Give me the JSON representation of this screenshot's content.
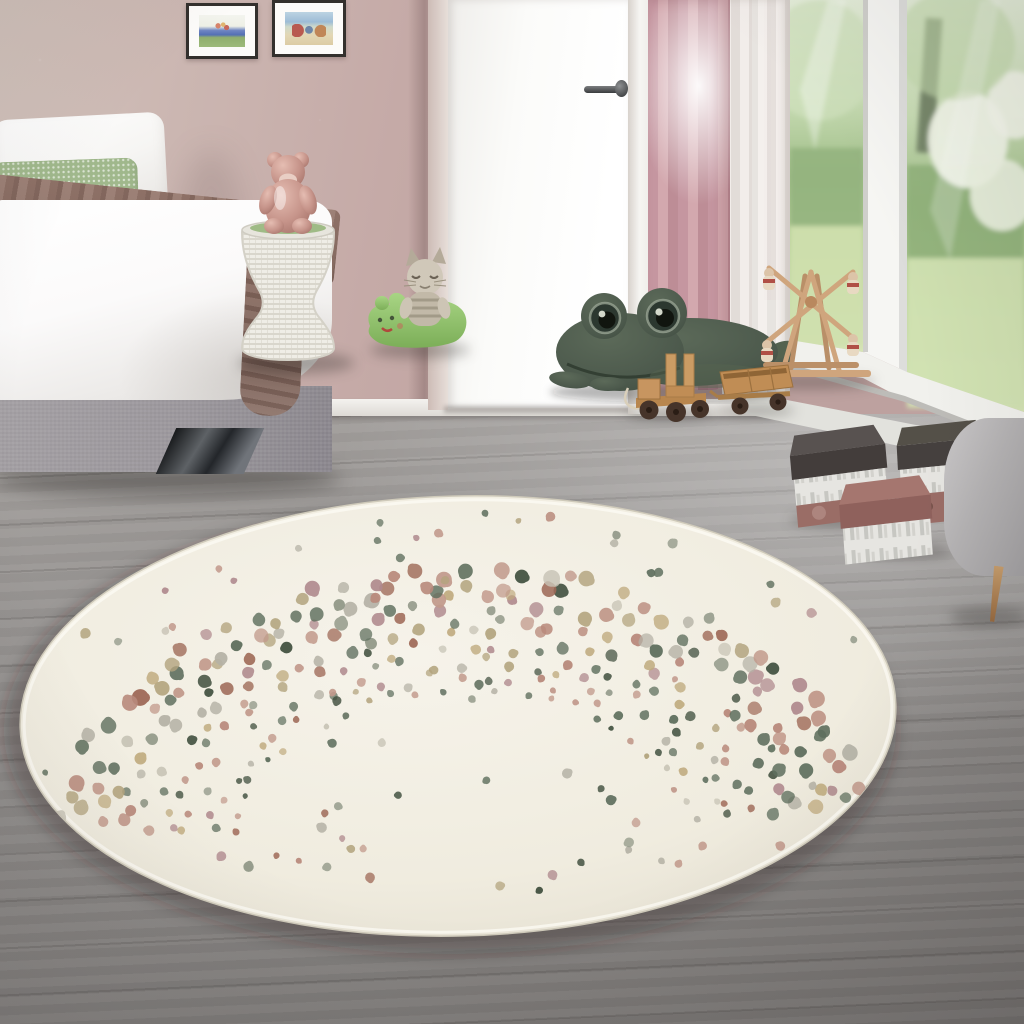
{
  "scene": {
    "type": "product-lifestyle-photo",
    "description": "Children's bedroom with dusty-pink walls, a bed with white bedding and a brown throw, a white woven stool with a rose gummy-bear figurine, plush toys (cat, green pillow animal, large green frog), wooden toys (ferris wheel, pull-along truck and cart), an open white door with pink and sheer curtains, a large garden window, decorative storage boxes, a grey armchair corner, grey wood floor, and a large round cream kids rug decorated with a rainbow arc of multicoloured speckled dots",
    "objects": [
      "wall",
      "framed-picture-left",
      "framed-picture-right",
      "bed",
      "white-pillow",
      "green-knit-pillow",
      "white-duvet",
      "brown-blanket",
      "bed-base",
      "chrome-bed-foot",
      "woven-stool",
      "gummy-bear-figurine",
      "cat-plush",
      "green-pillow-plush",
      "white-door",
      "door-handle",
      "pink-curtain",
      "sheer-curtain",
      "window-frame",
      "garden-view",
      "frog-plush",
      "ferris-wheel-wooden-toy",
      "wooden-truck-toy",
      "wooden-cart-toy",
      "storage-box-dark-lid-1",
      "storage-box-dark-lid-2",
      "storage-box-mauve-lid",
      "armchair",
      "wood-floor",
      "round-dotted-rug"
    ]
  },
  "palette": {
    "wall": "#c5aaa7",
    "wall_light": "#d2c3bc",
    "wall_deep": "#bfa2a0",
    "curtain_pink": "#c998a2",
    "pillow_green": "#a0b88c",
    "blanket": "#8a6f65",
    "bed_base": "#989499",
    "chair": "#b4b2b3",
    "frog": "#4c594c",
    "wood": "#c79a67",
    "wheel": "#46342a",
    "rug_base": "#f1ede2"
  },
  "rug_pattern": {
    "seed": 11,
    "ellipse": {
      "cx": 458,
      "cy": 716,
      "rx": 438,
      "ry": 220,
      "rotate_deg": -1.5
    },
    "band": {
      "cx": 460,
      "cy": 858,
      "rx": 408,
      "ry": 286,
      "inner": 0.58,
      "outer": 1.0,
      "rows": 9,
      "dots_min_per_row": 26,
      "dots_max_per_row": 46,
      "angle_start_deg": 8,
      "angle_end_deg": 172,
      "dot_r_min": 3.2,
      "dot_r_max": 6.8,
      "skip_chance": 0.07
    },
    "scatter": {
      "count": 64,
      "dot_r_min": 2.8,
      "dot_r_max": 5.2,
      "max_radius": 0.97
    },
    "colors": [
      "#41503f",
      "#5f6f5e",
      "#5f6f5e",
      "#8e9585",
      "#9f6a58",
      "#b98a7c",
      "#b98a7c",
      "#c29a8c",
      "#c0ab7f",
      "#b3a47e",
      "#c8c4b6",
      "#b5b2a6",
      "#b08a8e"
    ]
  }
}
